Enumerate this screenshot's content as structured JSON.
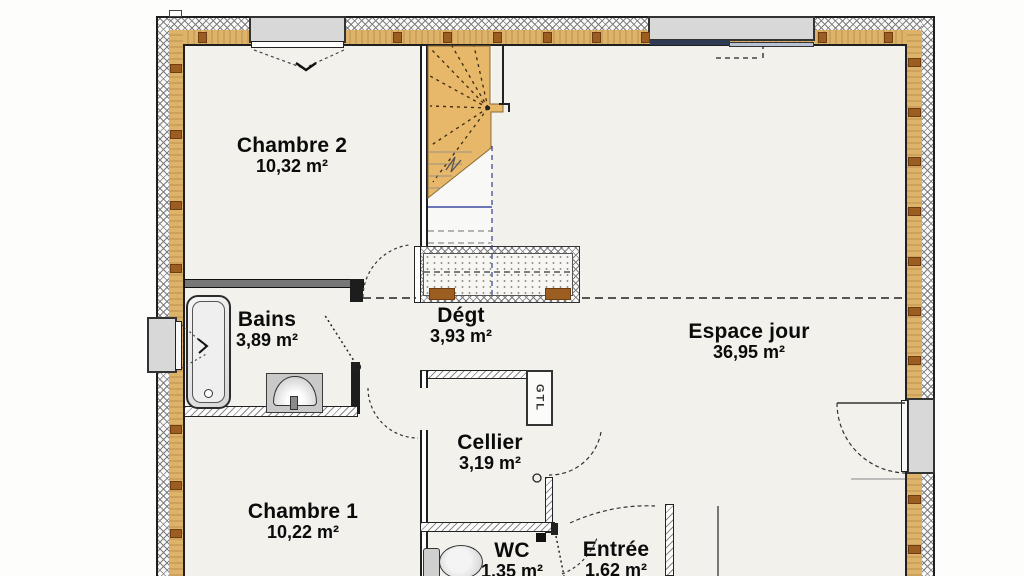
{
  "rooms": [
    {
      "id": "chambre2",
      "name": "Chambre 2",
      "area": "10,32 m²"
    },
    {
      "id": "bains",
      "name": "Bains",
      "area": "3,89 m²"
    },
    {
      "id": "degt",
      "name": "Dégt",
      "area": "3,93 m²"
    },
    {
      "id": "espace_jour",
      "name": "Espace jour",
      "area": "36,95 m²"
    },
    {
      "id": "cellier",
      "name": "Cellier",
      "area": "3,19 m²"
    },
    {
      "id": "chambre1",
      "name": "Chambre 1",
      "area": "10,22 m²"
    },
    {
      "id": "wc",
      "name": "WC",
      "area": "1,35 m²"
    },
    {
      "id": "entree",
      "name": "Entrée",
      "area": "1,62 m²"
    }
  ],
  "labels": {
    "gtl": "GTL"
  },
  "colors": {
    "wall_wood": "#ddb269",
    "wall_stud": "#9c5d20",
    "stairs": "#e7b76a",
    "window_frame": "#d8d8d8",
    "guide_blue": "#3f4a9e",
    "floor": "#f2f1ec"
  }
}
